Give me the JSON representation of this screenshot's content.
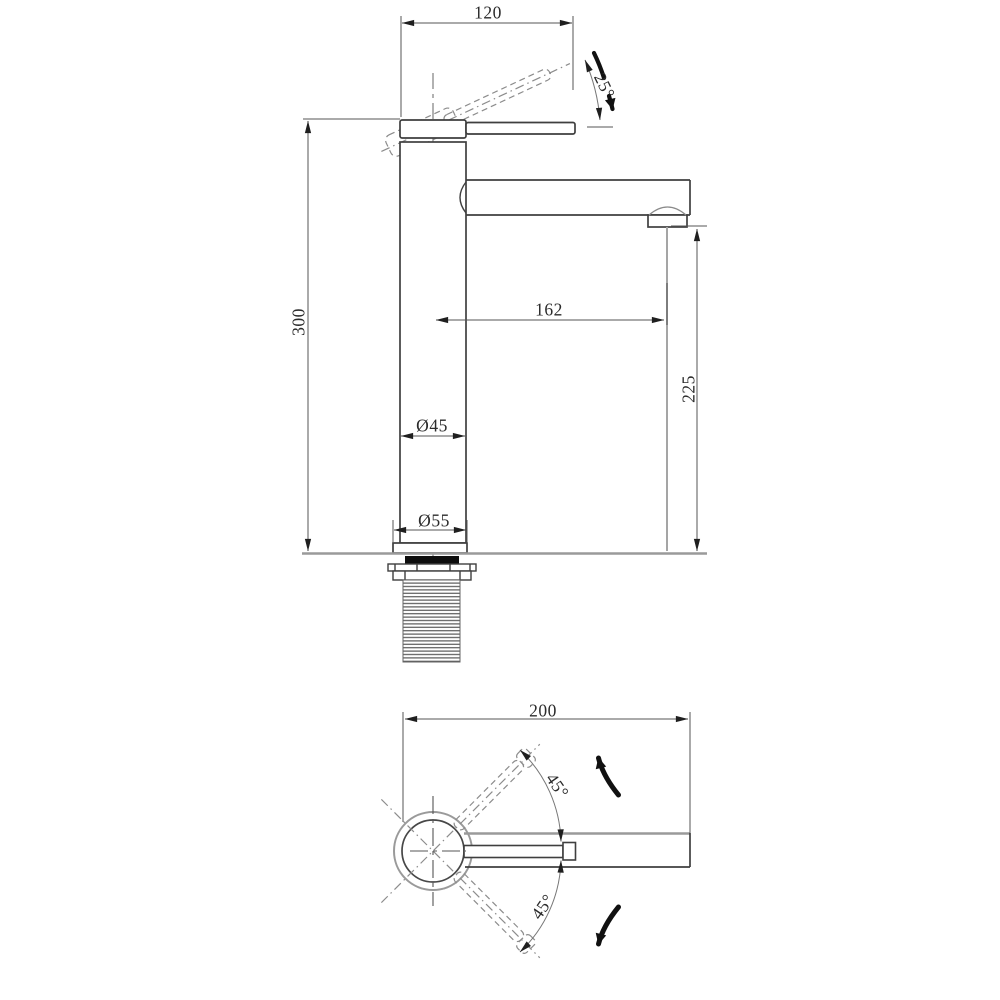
{
  "page": {
    "background": "#ffffff",
    "description": "faucet technical drawing, side elevation and top plan views"
  },
  "colors": {
    "outline": "#3f3f3f",
    "dim_line": "#555555",
    "arrow": "#1f1f1f",
    "ghost": "#8c8c8c",
    "centerline": "#666666",
    "heavy_gray": "#9a9a9a",
    "gasket": "#0d0d0d",
    "text": "#2b2b2b"
  },
  "side_view": {
    "label": "side elevation",
    "dimensions": {
      "handle_reach": "120",
      "handle_angle": "25°",
      "total_height": "300",
      "spout_reach": "162",
      "spout_height": "225",
      "body_diameter": "Ø45",
      "base_diameter": "Ø55"
    }
  },
  "plan_view": {
    "label": "top plan",
    "dimensions": {
      "overall_length": "200",
      "swivel_up": "45°",
      "swivel_down": "45°"
    }
  }
}
